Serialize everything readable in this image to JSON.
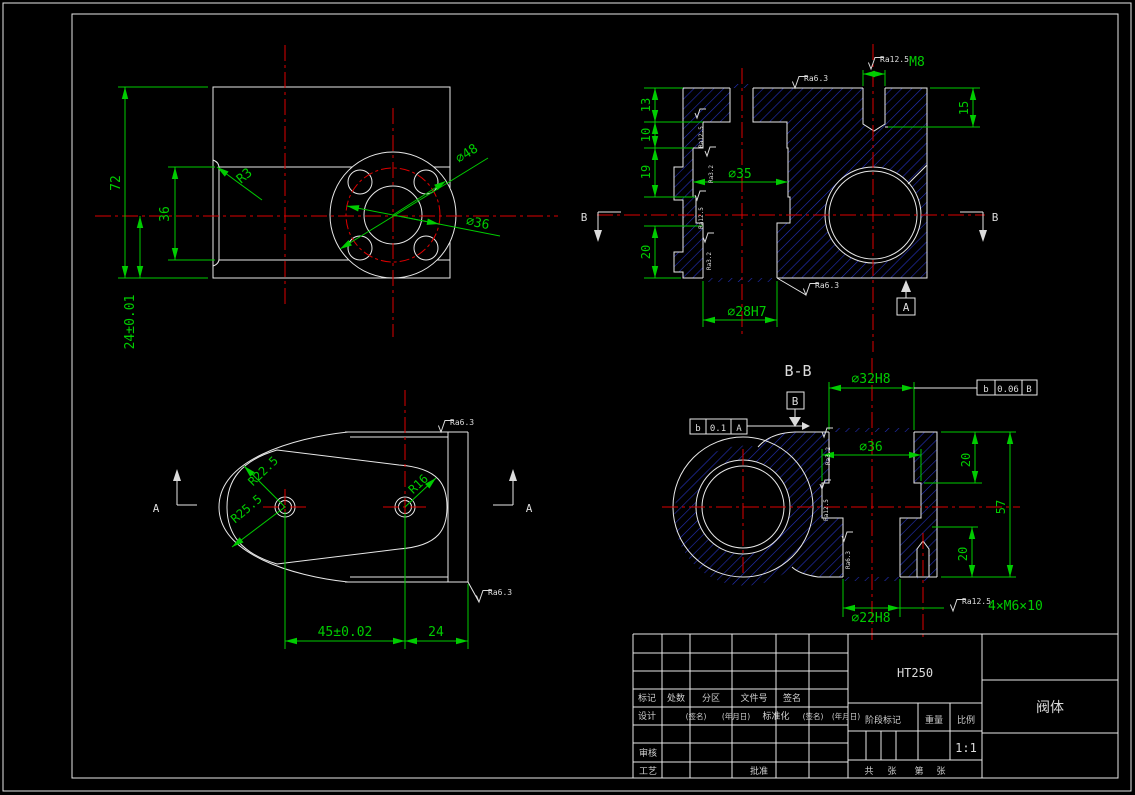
{
  "colors": {
    "background": "#000000",
    "outline": "#e8e8e8",
    "dimension": "#00cc00",
    "centerline": "#dd0000",
    "hatch": "#2431bb"
  },
  "views": {
    "plan": {
      "d72": "72",
      "d36": "36",
      "d24": "24±0.01",
      "r3": "R3",
      "d48": "⌀48",
      "dbc": "⌀36"
    },
    "front_section": {
      "d13": "13",
      "d10": "10",
      "d19": "19",
      "d20": "20",
      "d15": "15",
      "m8": "M8",
      "ra12_5": "Ra12.5",
      "ra6_3_top": "Ra6.3",
      "ra6_3_bottom": "Ra6.3",
      "d35": "⌀35",
      "d28h7": "⌀28H7",
      "datum_a": "A",
      "section_b": "B",
      "steps": [
        "Ra12.5",
        "Ra3.2",
        "Ra12.5",
        "Ra3.2"
      ]
    },
    "side": {
      "r22_5": "R22.5",
      "r25_5": "R25.5",
      "r16": "R16",
      "d45": "45±0.02",
      "d24": "24",
      "ra6_3_top": "Ra6.3",
      "ra6_3_bottom": "Ra6.3",
      "section_a": "A"
    },
    "section_bb": {
      "title": "B-B",
      "d32h8": "⌀32H8",
      "d36": "⌀36",
      "d20_top": "20",
      "d57": "57",
      "d20_bottom": "20",
      "d22h8": "⌀22H8",
      "m6": "4×M6×10",
      "ra12_5": "Ra12.5",
      "datum_b": "B",
      "fcf_top": {
        "sym": "b",
        "tol": "0.06",
        "datum": "B"
      },
      "fcf_left": {
        "sym": "b",
        "tol": "0.1",
        "datum": "A"
      },
      "steps": [
        "Ra3.2",
        "Ra12.5",
        "Ra6.3"
      ]
    }
  },
  "title_block": {
    "material": "HT250",
    "part_name": "阀体",
    "scale_value": "1:1",
    "labels": {
      "mark": "标记",
      "count": "处数",
      "zone": "分区",
      "file_no": "文件号",
      "signature": "签名",
      "design": "设计",
      "sig_paren": "(签名)",
      "date_paren": "(年月日)",
      "standardization": "标准化",
      "review": "审核",
      "process": "工艺",
      "approve": "批准",
      "stage_mark": "阶段标记",
      "weight": "重量",
      "scale": "比例",
      "sheet_total": "共",
      "sheet_zhang": "张",
      "sheet_no": "第",
      "sheet_zhang2": "张"
    }
  }
}
